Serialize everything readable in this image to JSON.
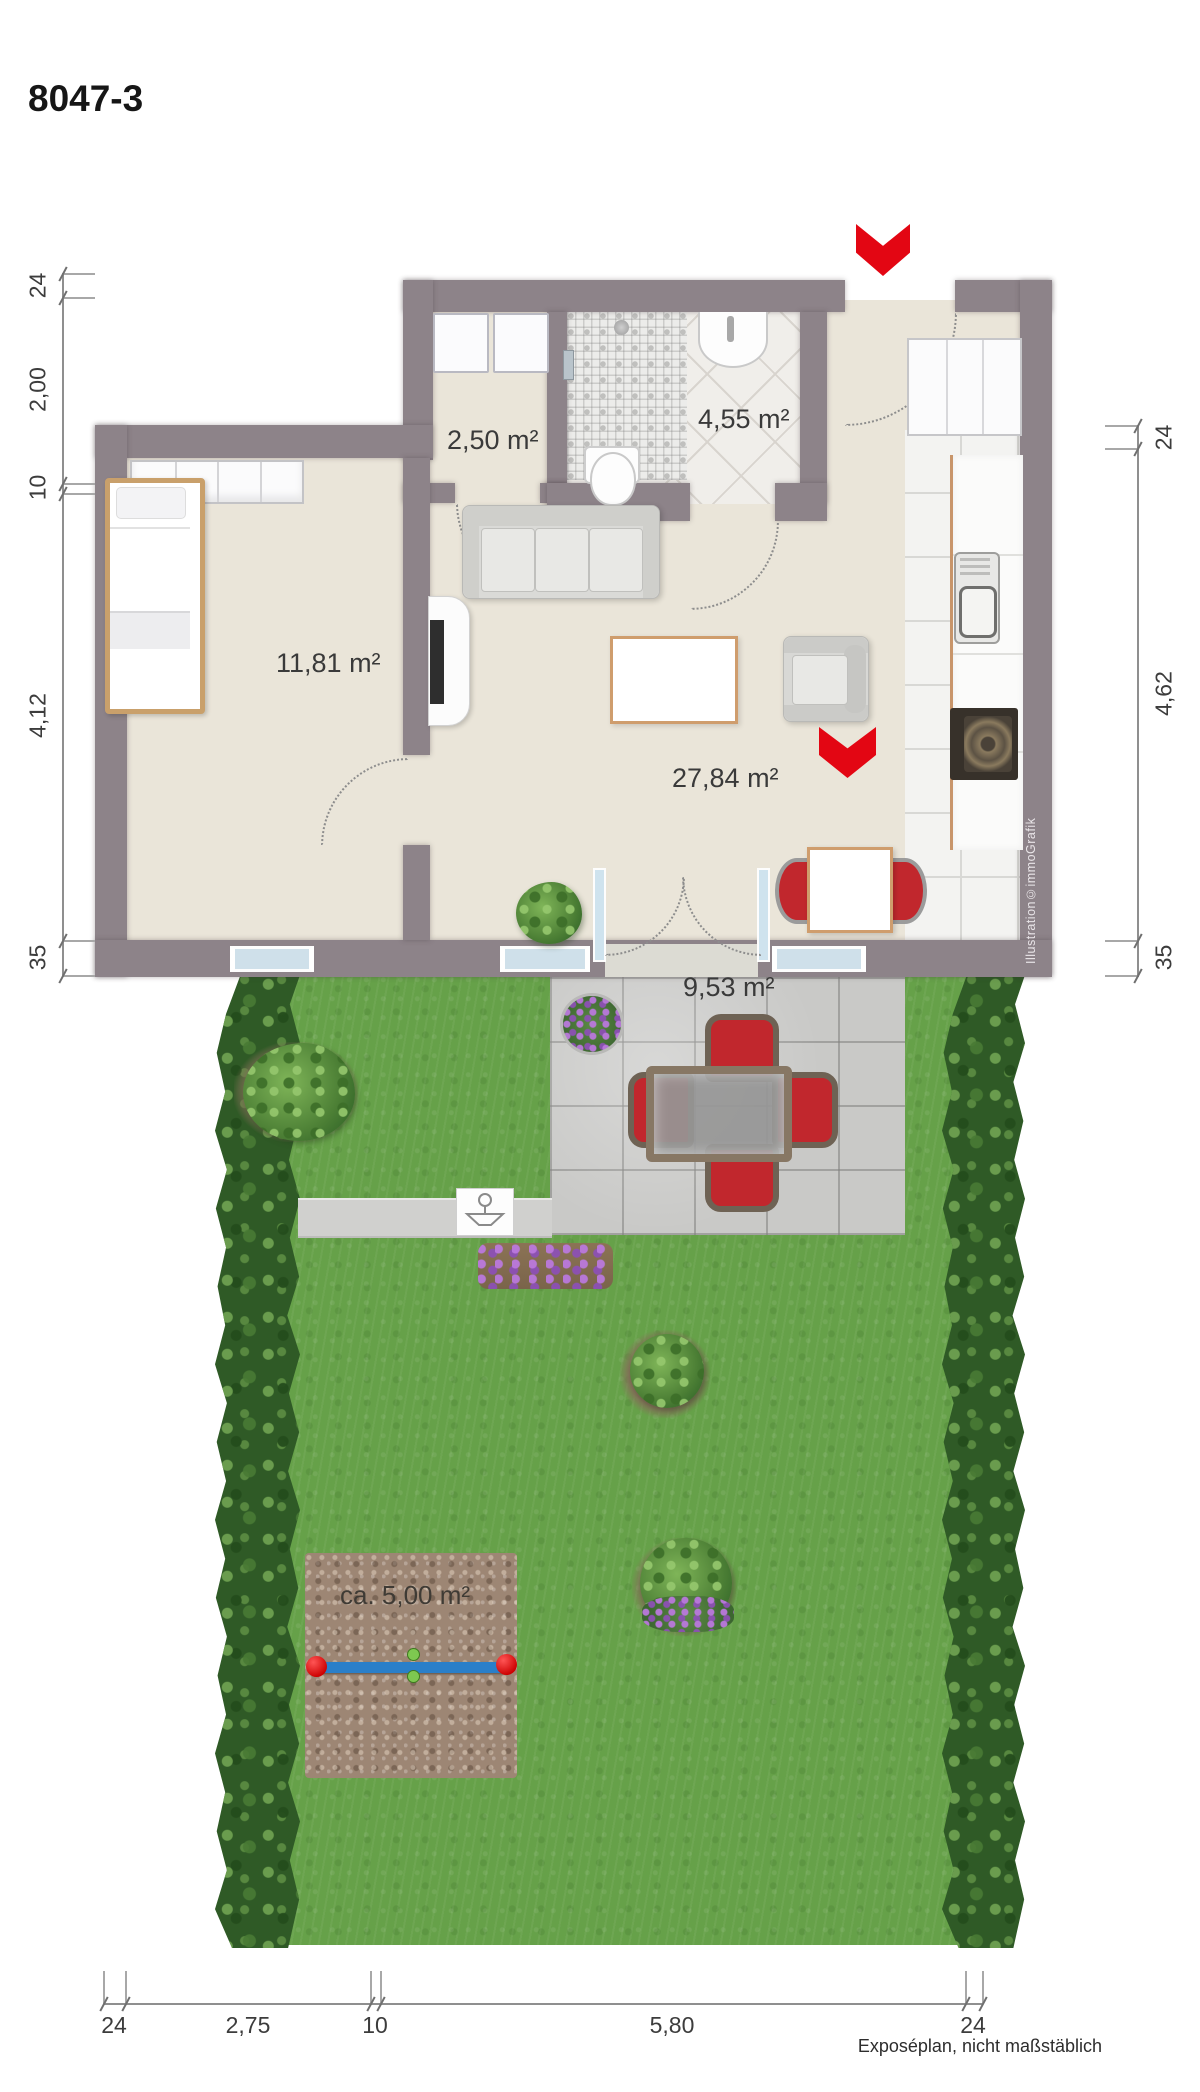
{
  "title": "8047-3",
  "rooms": {
    "utility": "2,50 m²",
    "bathroom": "4,55 m²",
    "bedroom": "11,81 m²",
    "living": "27,84 m²",
    "terrace": "9,53 m²",
    "play_area": "ca. 5,00 m²"
  },
  "dimensions": {
    "left": [
      "24",
      "2,00",
      "10",
      "4,12",
      "35"
    ],
    "right": [
      "24",
      "4,62",
      "35"
    ],
    "bottom": [
      "24",
      "2,75",
      "10",
      "5,80",
      "24"
    ]
  },
  "credit_vertical": "Illustration©immoGrafik",
  "footer_note": "Exposéplan, nicht maßstäblich",
  "colors": {
    "wall": "#8d8389",
    "floor_beige": "#eae5d9",
    "accent_red": "#e30613",
    "lawn_green": "#66a149",
    "hedge_green": "#2f5a26",
    "terrace_gray": "#c9c9c7",
    "chair_red": "#c1272d",
    "seesaw_blue": "#2a7fc9",
    "wood_trim": "#c8956a"
  }
}
